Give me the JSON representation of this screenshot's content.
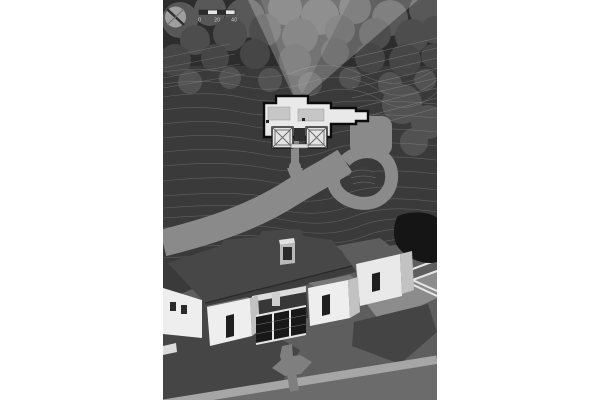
{
  "scale_bar": {
    "tick_labels": [
      "0",
      "20",
      "40"
    ]
  },
  "icons": {
    "north_arrow": "compass-circle-with-diagonal-needle",
    "scale_bar": "alternating-segment-bar"
  },
  "colors": {
    "page_bg": "#ffffff",
    "terrain": "#3a3a3a",
    "terrain_top": "#2d2d2d",
    "tree_light": "#585858",
    "tree_mid": "#4d4d4d",
    "tree_dark": "#464646",
    "tree_small": "#525252",
    "contour": "#a0a0a0",
    "view_cone": "#e9e9e9",
    "driveway": "#8a8a8a",
    "island": "#3c3c3c",
    "plan_fill": "#e9e9e9",
    "plan_outline": "#0c0c0c",
    "plan_roof": "#c6c6c6",
    "plan_porch": "#2f2f2f",
    "ground": "#5e5e5e",
    "lawn_shadow": "#454545",
    "terrace": "#8c8c8c",
    "terrace_shadow": "#444444",
    "path_light": "#a6a6a6",
    "walkway": "#7f7f7f",
    "pond": "#151515",
    "roof_dark": "#474747",
    "roof_mid": "#5d5d5d",
    "wall_light": "#eeeeee",
    "wall_shade": "#c2c2c2",
    "glass": "#181818",
    "mullion": "#e6e6e6",
    "compass_face": "#9f9f9f",
    "compass_needle": "#2e2e2e",
    "scale_bar_light": "#e6e6e6",
    "scale_bar_dark": "#2b2b2b",
    "scale_text": "#c9c9c9"
  }
}
